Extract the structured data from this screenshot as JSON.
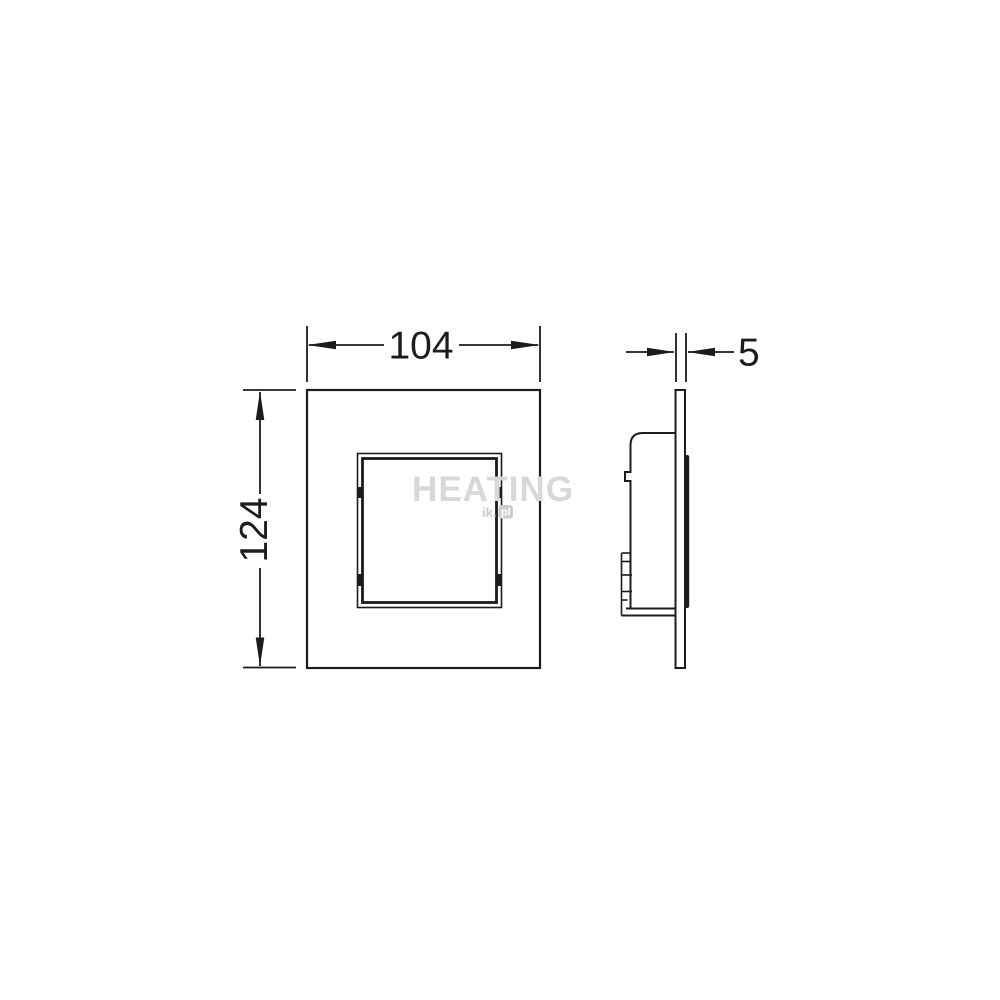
{
  "page": {
    "background_color": "#ffffff"
  },
  "drawing": {
    "description": "Technical dimension drawing of a square flush plate with central button: front view and side profile view",
    "colors": {
      "line": "#1c1c1c",
      "fill": "#ffffff",
      "watermark": "#d8d8d8",
      "watermark_badge_fill": "#cccccc",
      "watermark_badge_text": "#ffffff"
    },
    "front_view": {
      "width_dim": {
        "value": "104"
      },
      "height_dim": {
        "value": "124"
      }
    },
    "side_view": {
      "thickness_dim": {
        "value": "5"
      }
    },
    "watermark": {
      "title": "HEATING",
      "site_prefix": "ik.",
      "site_badge": "pl"
    }
  }
}
